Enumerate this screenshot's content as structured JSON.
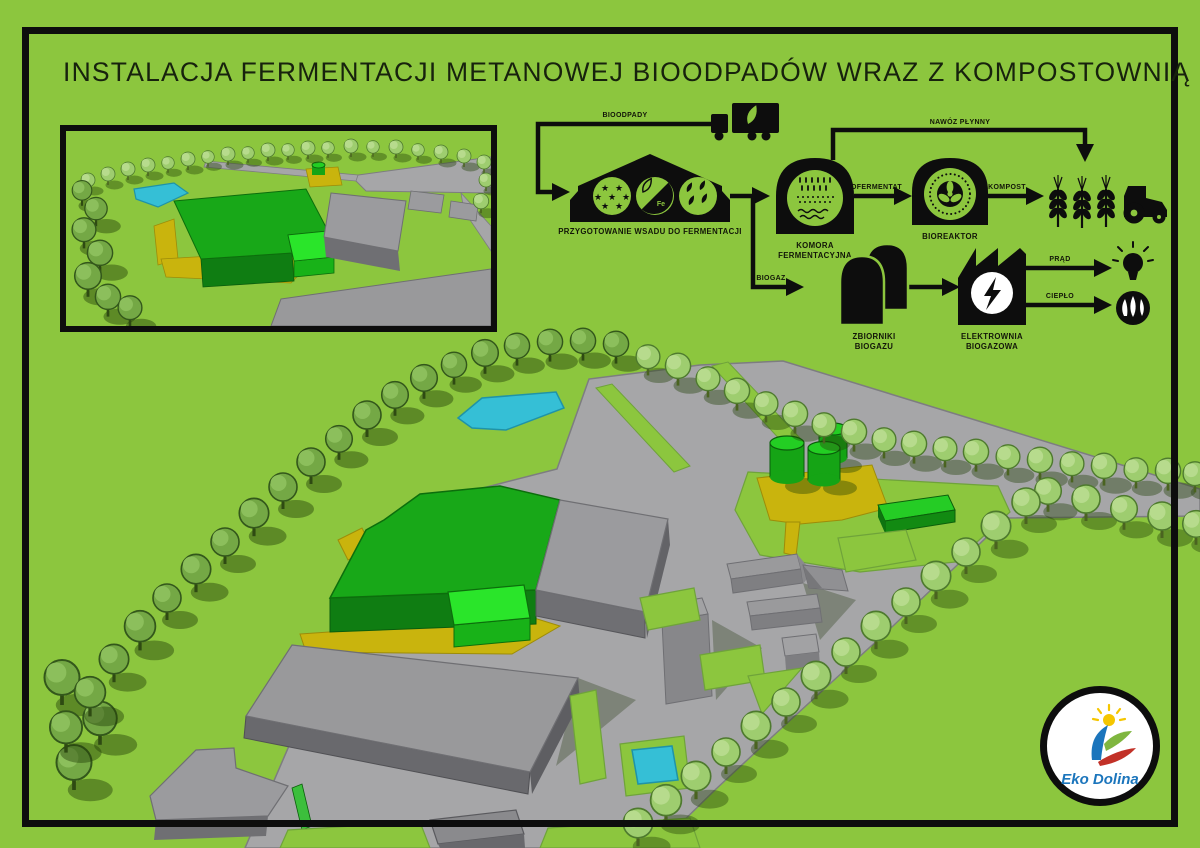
{
  "title": "INSTALACJA FERMENTACJI METANOWEJ BIOODPADÓW WRAZ Z KOMPOSTOWNIĄ",
  "flow": {
    "labels": {
      "bioodpady": "BIOODPADY",
      "nawoz_plynny": "NAWÓZ PŁYNNY",
      "pofermentat": "POFERMENTAT",
      "kompost": "KOMPOST",
      "biogaz": "BIOGAZ",
      "prad": "PRĄD",
      "cieplo": "CIEPŁO",
      "fe": "Fe"
    },
    "stations": {
      "przygotowanie": "PRZYGOTOWANIE WSADU DO FERMENTACJI",
      "komora_1": "KOMORA",
      "komora_2": "FERMENTACYJNA",
      "bioreaktor": "BIOREAKTOR",
      "zbiorniki_1": "ZBIORNIKI",
      "zbiorniki_2": "BIOGAZU",
      "elektrownia_1": "ELEKTROWNIA",
      "elektrownia_2": "BIOGAZOWA"
    },
    "icons": [
      "truck-icon",
      "barn-icon",
      "stars-icon",
      "fe-leaf-icon",
      "leaves-icon",
      "fermentation-chamber-icon",
      "bioreactor-icon",
      "wheat-icon",
      "tractor-icon",
      "biogas-tanks-icon",
      "power-plant-icon",
      "bulb-icon",
      "flame-icon"
    ]
  },
  "icons": {
    "star": "★"
  },
  "logo": {
    "text": "Eko Dolina"
  },
  "palette": {
    "background_green": "#8CC63E",
    "ink_black": "#0d0d0d",
    "road_grey": "#A6A6A8",
    "building_grey_top": "#9B9B9E",
    "building_grey_side": "#6F6F73",
    "building_green_top": "#18A818",
    "building_green_side": "#0F7D12",
    "building_lightgreen": "#2AE52A",
    "yellow_ground": "#C9B40D",
    "water_cyan": "#35BFD6",
    "tree_light": "#9ECD6F",
    "tree_dark": "#74A845",
    "logo_blue": "#1B75BC",
    "logo_red": "#C23128",
    "logo_yellow": "#F5C600",
    "logo_green": "#7FB63F"
  }
}
